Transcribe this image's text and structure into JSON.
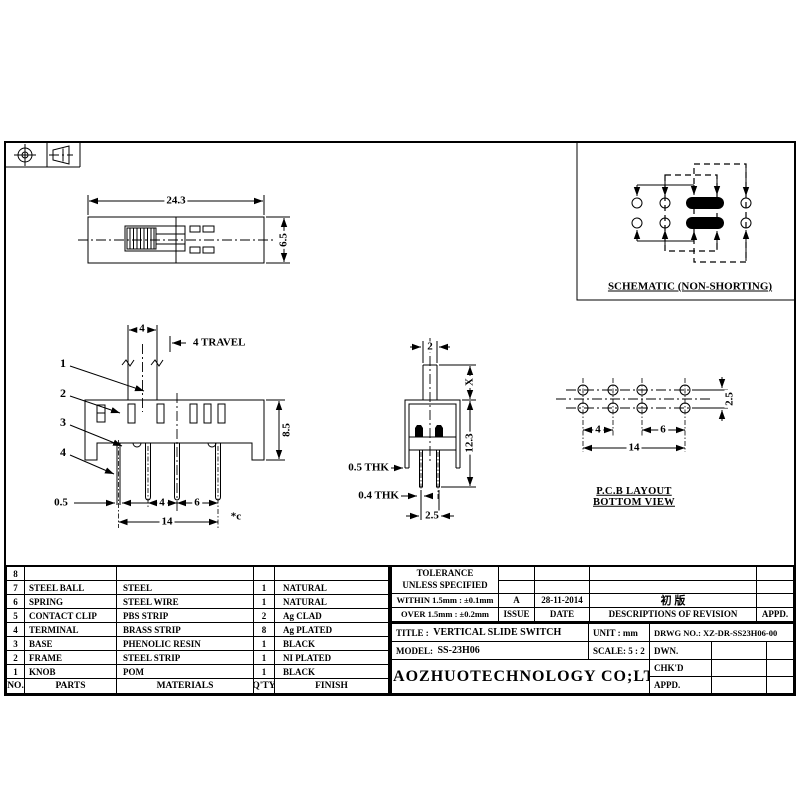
{
  "sheet": {
    "projection_symbol": "third-angle-projection"
  },
  "schematic": {
    "caption": "SCHEMATIC (NON-SHORTING)"
  },
  "views": {
    "top": {
      "dim_width": "24.3",
      "dim_height": "6.5"
    },
    "front": {
      "dim_knob_width": "4",
      "travel_note": "4 TRAVEL",
      "dim_height": "8.5",
      "dim_pin_thk": "0.5",
      "dim_pitch_a": "4",
      "dim_pitch_b": "6",
      "dim_total": "14",
      "note": "*c",
      "callout_1": "1",
      "callout_2": "2",
      "callout_3": "3",
      "callout_4": "4"
    },
    "side": {
      "dim_knob_width": "2",
      "dim_knob_height": "X",
      "dim_total_height": "12.3",
      "note_frame_thk": "0.5 THK",
      "note_pin_thk": "0.4 THK",
      "dim_pin_span": "2.5"
    },
    "pcb": {
      "caption_line1": "P.C.B LAYOUT",
      "caption_line2": "BOTTOM VIEW",
      "dim_row_pitch": "2.5",
      "dim_pitch_a": "4",
      "dim_pitch_b": "6",
      "dim_total": "14"
    }
  },
  "parts_table": {
    "headers": {
      "no": "NO.",
      "parts": "PARTS",
      "materials": "MATERIALS",
      "qty": "Q'TY",
      "finish": "FINISH"
    },
    "rows": [
      {
        "no": "8",
        "part": "",
        "material": "",
        "qty": "",
        "finish": ""
      },
      {
        "no": "7",
        "part": "STEEL BALL",
        "material": "STEEL",
        "qty": "1",
        "finish": "NATURAL"
      },
      {
        "no": "6",
        "part": "SPRING",
        "material": "STEEL WIRE",
        "qty": "1",
        "finish": "NATURAL"
      },
      {
        "no": "5",
        "part": "CONTACT CLIP",
        "material": "PBS STRIP",
        "qty": "2",
        "finish": "Ag CLAD"
      },
      {
        "no": "4",
        "part": "TERMINAL",
        "material": "BRASS STRIP",
        "qty": "8",
        "finish": "Ag PLATED"
      },
      {
        "no": "3",
        "part": "BASE",
        "material": "PHENOLIC RESIN",
        "qty": "1",
        "finish": "BLACK"
      },
      {
        "no": "2",
        "part": "FRAME",
        "material": "STEEL STRIP",
        "qty": "1",
        "finish": "NI PLATED"
      },
      {
        "no": "1",
        "part": "KNOB",
        "material": "POM",
        "qty": "1",
        "finish": "BLACK"
      }
    ]
  },
  "title_block": {
    "tolerance_line1": "TOLERANCE",
    "tolerance_line2": "UNLESS  SPECIFIED",
    "tolerance_within": "WITHIN 1.5mm : ±0.1mm",
    "tolerance_over": "OVER 1.5mm : ±0.2mm",
    "issue_value": "A",
    "date_value": "28-11-2014",
    "revision_value": "初 版",
    "issue_label": "ISSUE",
    "date_label": "DATE",
    "revision_label": "DESCRIPTIONS OF REVISION",
    "rev_appd_label": "APPD.",
    "title_label": "TITLE :",
    "title_value": "VERTICAL SLIDE SWITCH",
    "unit_label": "UNIT :",
    "unit_value": "mm",
    "drwg_no": "DRWG NO.: XZ-DR-SS23H06-00",
    "model_label": "MODEL:",
    "model_value": "SS-23H06",
    "scale_label": "SCALE:",
    "scale_value": "5 : 2",
    "dwn_label": "DWN.",
    "chkd_label": "CHK'D",
    "appd_label": "APPD.",
    "company": "XIAOZHUOTECHNOLOGY  CO;LTD"
  }
}
